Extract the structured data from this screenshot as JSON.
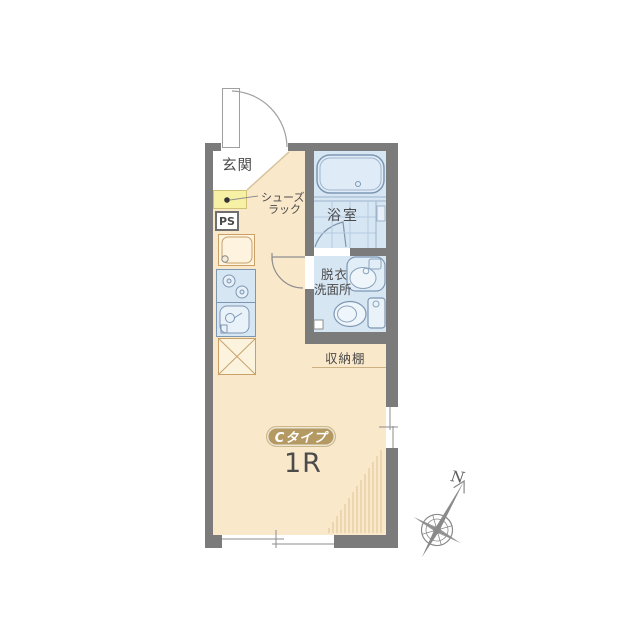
{
  "floorplan": {
    "badge": "Cタイプ",
    "layout": "1R",
    "labels": {
      "entrance": "玄関",
      "bathroom": "浴室",
      "washroom_line1": "脱衣",
      "washroom_line2": "洗面所",
      "shoe_rack_line1": "シューズ",
      "shoe_rack_line2": "ラック",
      "pipe_space": "PS",
      "storage_shelf": "収納棚"
    },
    "compass": {
      "north": "N"
    },
    "colors": {
      "wall_gray": "#7b7b7b",
      "room_beige": "#fae8cb",
      "wet_area_blue": "#d6e6f3",
      "fixture_stroke_blue": "#7d97b3",
      "furniture_tan": "#c9a168",
      "shoe_rack_yellow": "#f6f1a4",
      "badge_gold": "#b49a62",
      "hatch_tan": "#dcc395",
      "text_dark": "#4a4a4a",
      "compass_gray": "#8a8a8a"
    }
  }
}
